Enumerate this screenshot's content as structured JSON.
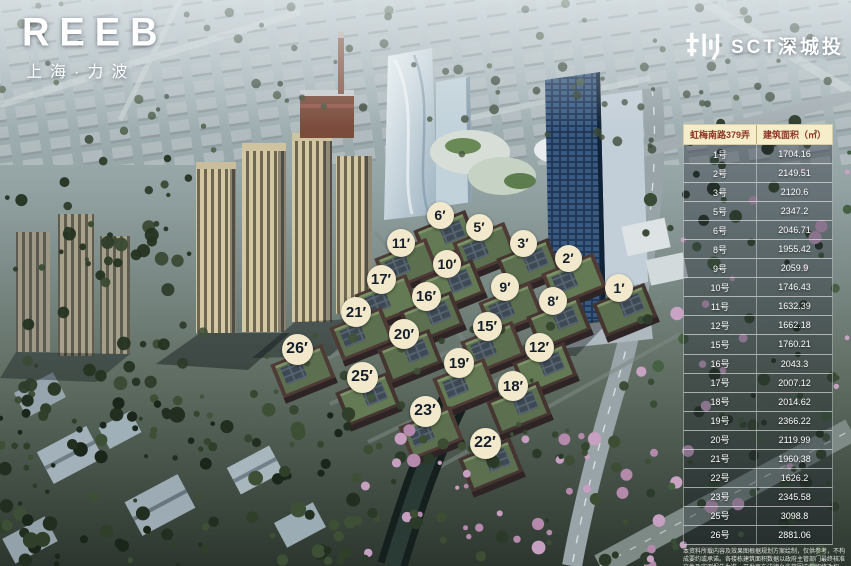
{
  "brand": {
    "logo": "REEB",
    "subtitle": "上海·力波"
  },
  "developer": {
    "name": "SCT深城投",
    "icon": "shencheng-city-glyph"
  },
  "colors": {
    "marker_bg": "#f2e9cd",
    "marker_text": "#141e2a",
    "table_header_bg": "#f6eecb",
    "table_header_text": "#8c3524",
    "table_row_text": "#ffffff"
  },
  "table": {
    "header": {
      "road": "虹梅南路379弄",
      "area": "建筑面积（㎡）"
    },
    "rows": [
      {
        "unit": "1号",
        "area": "1704.16"
      },
      {
        "unit": "2号",
        "area": "2149.51"
      },
      {
        "unit": "3号",
        "area": "2120.6"
      },
      {
        "unit": "5号",
        "area": "2347.2"
      },
      {
        "unit": "6号",
        "area": "2046.71"
      },
      {
        "unit": "8号",
        "area": "1955.42"
      },
      {
        "unit": "9号",
        "area": "2059.9"
      },
      {
        "unit": "10号",
        "area": "1746.43"
      },
      {
        "unit": "11号",
        "area": "1632.39"
      },
      {
        "unit": "12号",
        "area": "1662.18"
      },
      {
        "unit": "15号",
        "area": "1760.21"
      },
      {
        "unit": "16号",
        "area": "2043.3"
      },
      {
        "unit": "17号",
        "area": "2007.12"
      },
      {
        "unit": "18号",
        "area": "2014.62"
      },
      {
        "unit": "19号",
        "area": "2366.22"
      },
      {
        "unit": "20号",
        "area": "2119.99"
      },
      {
        "unit": "21号",
        "area": "1960.38"
      },
      {
        "unit": "22号",
        "area": "1626.2"
      },
      {
        "unit": "23号",
        "area": "2345.58"
      },
      {
        "unit": "25号",
        "area": "3098.8"
      },
      {
        "unit": "26号",
        "area": "2881.06"
      }
    ]
  },
  "markers": [
    {
      "label": "6′",
      "x": 440,
      "y": 215,
      "s": 27
    },
    {
      "label": "5′",
      "x": 479,
      "y": 227,
      "s": 27
    },
    {
      "label": "3′",
      "x": 523,
      "y": 243,
      "s": 27
    },
    {
      "label": "2′",
      "x": 568,
      "y": 258,
      "s": 27
    },
    {
      "label": "1′",
      "x": 619,
      "y": 288,
      "s": 28
    },
    {
      "label": "11′",
      "x": 401,
      "y": 243,
      "s": 28
    },
    {
      "label": "10′",
      "x": 447,
      "y": 264,
      "s": 28
    },
    {
      "label": "9′",
      "x": 505,
      "y": 287,
      "s": 28
    },
    {
      "label": "8′",
      "x": 553,
      "y": 301,
      "s": 28
    },
    {
      "label": "17′",
      "x": 381,
      "y": 279,
      "s": 29
    },
    {
      "label": "16′",
      "x": 426,
      "y": 296,
      "s": 29
    },
    {
      "label": "15′",
      "x": 487,
      "y": 326,
      "s": 29
    },
    {
      "label": "12′",
      "x": 539,
      "y": 347,
      "s": 29
    },
    {
      "label": "21′",
      "x": 356,
      "y": 312,
      "s": 30
    },
    {
      "label": "20′",
      "x": 404,
      "y": 334,
      "s": 30
    },
    {
      "label": "19′",
      "x": 459,
      "y": 363,
      "s": 30
    },
    {
      "label": "18′",
      "x": 513,
      "y": 386,
      "s": 30
    },
    {
      "label": "26′",
      "x": 297,
      "y": 349,
      "s": 31
    },
    {
      "label": "25′",
      "x": 362,
      "y": 377,
      "s": 31
    },
    {
      "label": "23′",
      "x": 425,
      "y": 411,
      "s": 31
    },
    {
      "label": "22′",
      "x": 485,
      "y": 443,
      "s": 31
    }
  ],
  "disclaimer": "本资料所载内容及效果图根据规划方案绘制，仅供参考，不构成要约或承诺。各楼栋建筑面积数据以政府主管部门最终核准文件及实测报告为准，开发商在法律允许范围内保留修改权利，解释权归开发商所有。"
}
